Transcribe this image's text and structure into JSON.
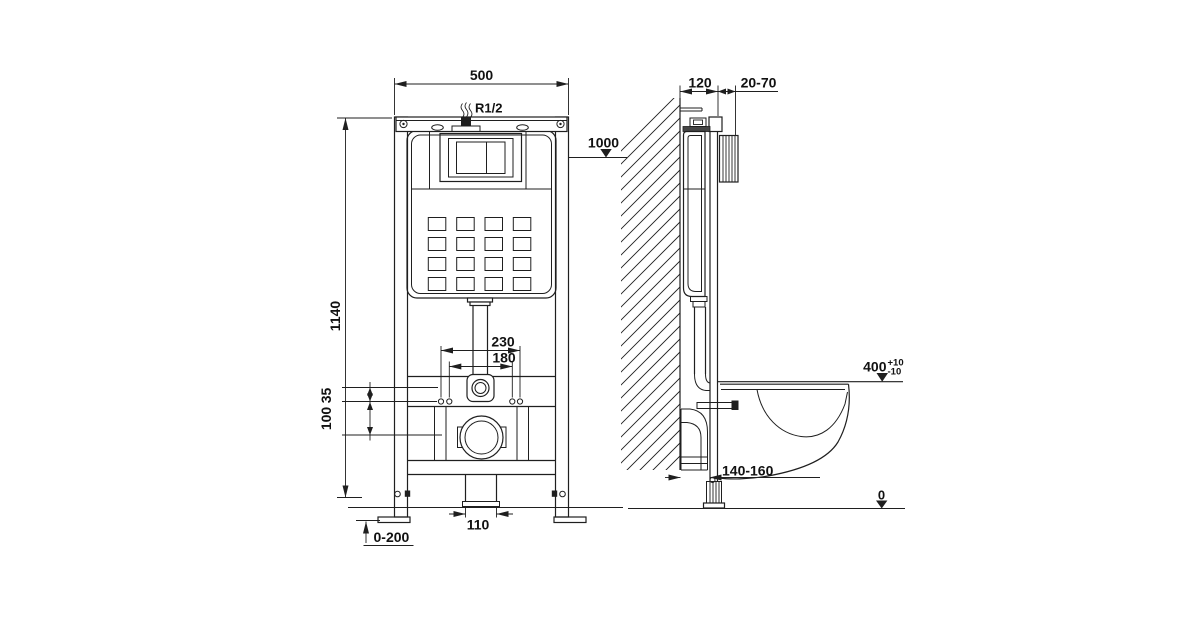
{
  "colors": {
    "background": "#ffffff",
    "line": "#1f1f1f",
    "text": "#111111"
  },
  "front_view": {
    "width": "500",
    "inlet_thread": "R1/2",
    "flush_button_height": "1000",
    "frame_height": "1140",
    "fixing_span_outer": "230",
    "fixing_span_inner": "180",
    "offset_fitting_to_holes": "35",
    "offset_holes_to_outlet": "100",
    "outlet_diameter": "110",
    "leg_adjustment": "0-200"
  },
  "side_view": {
    "frame_depth": "120",
    "finished_wall_range": "20-70",
    "seat_height": "400",
    "seat_tol_plus": "+10",
    "seat_tol_minus": "-10",
    "waste_outlet_offset": "140-160",
    "floor_level": "0"
  }
}
